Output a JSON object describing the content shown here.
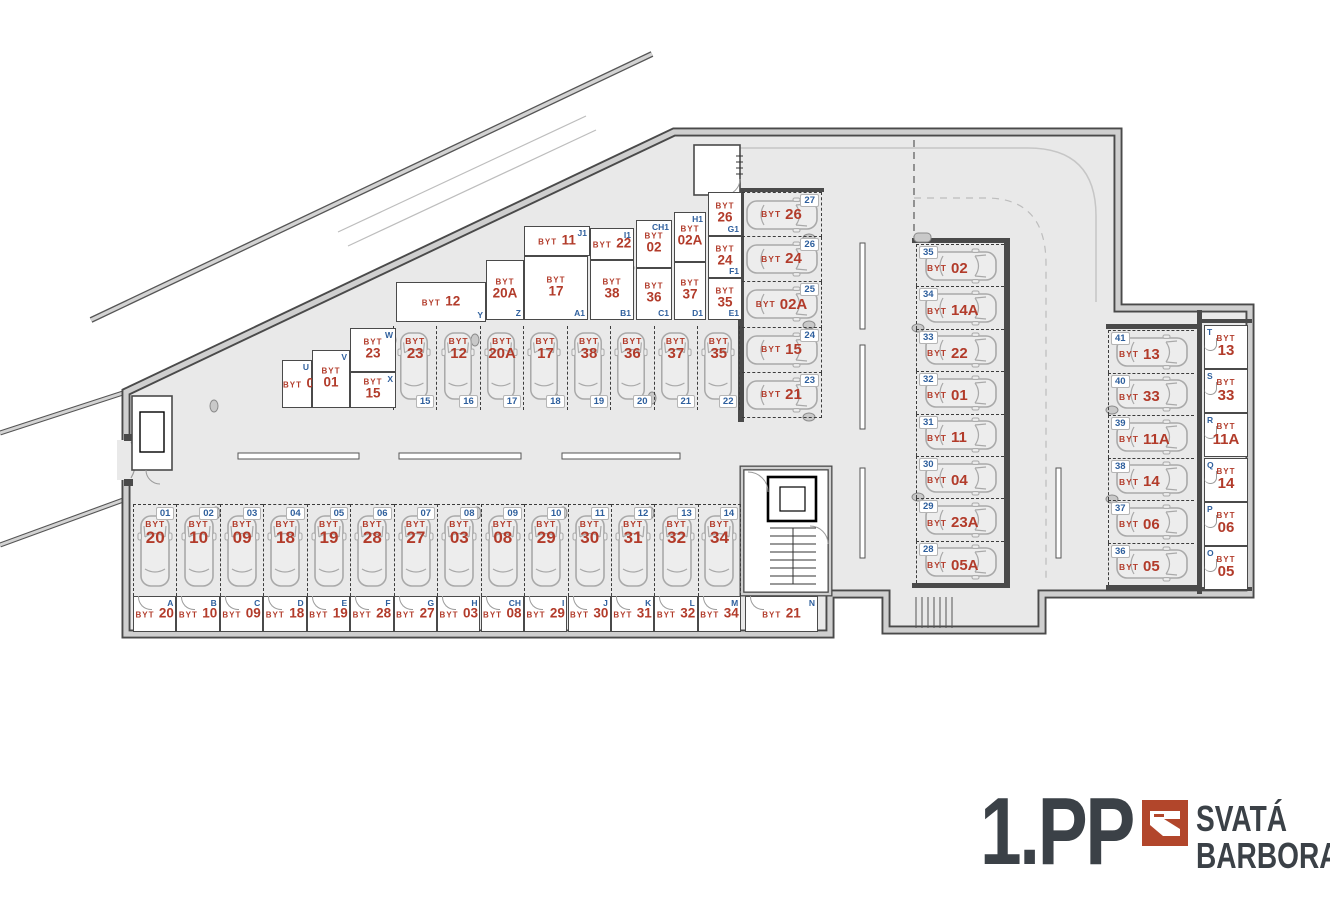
{
  "labels": {
    "unit_prefix": "BYT"
  },
  "title": {
    "floor": "1.PP",
    "brand_line1": "SVATÁ",
    "brand_line2": "BARBORA"
  },
  "colors": {
    "unit_red": "#b23b2a",
    "mark_blue": "#2e5f9d",
    "brand_rust": "#b2462b",
    "wall_dark": "#4a4a4a",
    "floor_gray": "#e9e9e9"
  },
  "parking": {
    "bottom_row": [
      {
        "num": "01",
        "unit": "20",
        "x": 133,
        "y": 504,
        "w": 43.4,
        "h": 92
      },
      {
        "num": "02",
        "unit": "10",
        "x": 176.4,
        "y": 504,
        "w": 43.4,
        "h": 92
      },
      {
        "num": "03",
        "unit": "09",
        "x": 219.9,
        "y": 504,
        "w": 43.4,
        "h": 92
      },
      {
        "num": "04",
        "unit": "18",
        "x": 263.3,
        "y": 504,
        "w": 43.4,
        "h": 92
      },
      {
        "num": "05",
        "unit": "19",
        "x": 306.8,
        "y": 504,
        "w": 43.4,
        "h": 92
      },
      {
        "num": "06",
        "unit": "28",
        "x": 350.2,
        "y": 504,
        "w": 43.4,
        "h": 92
      },
      {
        "num": "07",
        "unit": "27",
        "x": 393.7,
        "y": 504,
        "w": 43.4,
        "h": 92
      },
      {
        "num": "08",
        "unit": "03",
        "x": 437.1,
        "y": 504,
        "w": 43.4,
        "h": 92
      },
      {
        "num": "09",
        "unit": "08",
        "x": 480.6,
        "y": 504,
        "w": 43.4,
        "h": 92
      },
      {
        "num": "10",
        "unit": "29",
        "x": 524,
        "y": 504,
        "w": 43.4,
        "h": 92
      },
      {
        "num": "11",
        "unit": "30",
        "x": 567.5,
        "y": 504,
        "w": 43.4,
        "h": 92
      },
      {
        "num": "12",
        "unit": "31",
        "x": 610.9,
        "y": 504,
        "w": 43.4,
        "h": 92
      },
      {
        "num": "13",
        "unit": "32",
        "x": 654.4,
        "y": 504,
        "w": 43.4,
        "h": 92
      },
      {
        "num": "14",
        "unit": "34",
        "x": 697.8,
        "y": 504,
        "w": 43.4,
        "h": 92,
        "cls": "last"
      }
    ],
    "diagonal_row": [
      {
        "num": "15",
        "unit": "23",
        "x": 393,
        "y": 326,
        "w": 43.4,
        "h": 84
      },
      {
        "num": "16",
        "unit": "12",
        "x": 436.4,
        "y": 326,
        "w": 43.4,
        "h": 84
      },
      {
        "num": "17",
        "unit": "20A",
        "x": 479.9,
        "y": 326,
        "w": 43.4,
        "h": 84
      },
      {
        "num": "18",
        "unit": "17",
        "x": 523.3,
        "y": 326,
        "w": 43.4,
        "h": 84
      },
      {
        "num": "19",
        "unit": "38",
        "x": 566.8,
        "y": 326,
        "w": 43.4,
        "h": 84
      },
      {
        "num": "20",
        "unit": "36",
        "x": 610.2,
        "y": 326,
        "w": 43.4,
        "h": 84
      },
      {
        "num": "21",
        "unit": "37",
        "x": 653.7,
        "y": 326,
        "w": 43.4,
        "h": 84
      },
      {
        "num": "22",
        "unit": "35",
        "x": 697.1,
        "y": 326,
        "w": 43.4,
        "h": 84,
        "cls": "last"
      }
    ],
    "mid_stack": [
      {
        "num": "27",
        "unit": "26",
        "x": 742,
        "y": 192,
        "w": 80,
        "h": 45.2,
        "cls": "first"
      },
      {
        "num": "26",
        "unit": "24",
        "x": 742,
        "y": 237.2,
        "w": 80,
        "h": 45.2
      },
      {
        "num": "25",
        "unit": "02A",
        "x": 742,
        "y": 282.4,
        "w": 80,
        "h": 45.2
      },
      {
        "num": "24",
        "unit": "15",
        "x": 742,
        "y": 327.6,
        "w": 80,
        "h": 45.2
      },
      {
        "num": "23",
        "unit": "21",
        "x": 742,
        "y": 372.8,
        "w": 80,
        "h": 45.2
      }
    ],
    "right_column": [
      {
        "num": "35",
        "unit": "02",
        "x": 916,
        "y": 244,
        "w": 88,
        "h": 42.4
      },
      {
        "num": "34",
        "unit": "14A",
        "x": 916,
        "y": 286.4,
        "w": 88,
        "h": 42.4
      },
      {
        "num": "33",
        "unit": "22",
        "x": 916,
        "y": 328.8,
        "w": 88,
        "h": 42.4
      },
      {
        "num": "32",
        "unit": "01",
        "x": 916,
        "y": 371.2,
        "w": 88,
        "h": 42.4
      },
      {
        "num": "31",
        "unit": "11",
        "x": 916,
        "y": 413.6,
        "w": 88,
        "h": 42.4
      },
      {
        "num": "30",
        "unit": "04",
        "x": 916,
        "y": 456,
        "w": 88,
        "h": 42.4
      },
      {
        "num": "29",
        "unit": "23A",
        "x": 916,
        "y": 498.4,
        "w": 88,
        "h": 42.4
      },
      {
        "num": "28",
        "unit": "05A",
        "x": 916,
        "y": 540.8,
        "w": 88,
        "h": 42.4
      }
    ],
    "far_right_column": [
      {
        "num": "41",
        "unit": "13",
        "x": 1108,
        "y": 330,
        "w": 86,
        "h": 42.5
      },
      {
        "num": "40",
        "unit": "33",
        "x": 1108,
        "y": 372.5,
        "w": 86,
        "h": 42.5
      },
      {
        "num": "39",
        "unit": "11A",
        "x": 1108,
        "y": 415,
        "w": 86,
        "h": 42.5
      },
      {
        "num": "38",
        "unit": "14",
        "x": 1108,
        "y": 457.5,
        "w": 86,
        "h": 42.5
      },
      {
        "num": "37",
        "unit": "06",
        "x": 1108,
        "y": 500,
        "w": 86,
        "h": 42.5
      },
      {
        "num": "36",
        "unit": "05",
        "x": 1108,
        "y": 542.5,
        "w": 86,
        "h": 42.5
      }
    ]
  },
  "cellars": {
    "bottom_row": [
      {
        "letter": "A",
        "unit": "20",
        "x": 133,
        "y": 596,
        "w": 43.4,
        "h": 36
      },
      {
        "letter": "B",
        "unit": "10",
        "x": 176.4,
        "y": 596,
        "w": 43.4,
        "h": 36
      },
      {
        "letter": "C",
        "unit": "09",
        "x": 219.9,
        "y": 596,
        "w": 43.4,
        "h": 36
      },
      {
        "letter": "D",
        "unit": "18",
        "x": 263.3,
        "y": 596,
        "w": 43.4,
        "h": 36
      },
      {
        "letter": "E",
        "unit": "19",
        "x": 306.8,
        "y": 596,
        "w": 43.4,
        "h": 36
      },
      {
        "letter": "F",
        "unit": "28",
        "x": 350.2,
        "y": 596,
        "w": 43.4,
        "h": 36
      },
      {
        "letter": "G",
        "unit": "27",
        "x": 393.7,
        "y": 596,
        "w": 43.4,
        "h": 36
      },
      {
        "letter": "H",
        "unit": "03",
        "x": 437.1,
        "y": 596,
        "w": 43.4,
        "h": 36
      },
      {
        "letter": "CH",
        "unit": "08",
        "x": 480.6,
        "y": 596,
        "w": 43.4,
        "h": 36
      },
      {
        "letter": "I",
        "unit": "29",
        "x": 524,
        "y": 596,
        "w": 43.4,
        "h": 36
      },
      {
        "letter": "J",
        "unit": "30",
        "x": 567.5,
        "y": 596,
        "w": 43.4,
        "h": 36
      },
      {
        "letter": "K",
        "unit": "31",
        "x": 610.9,
        "y": 596,
        "w": 43.4,
        "h": 36
      },
      {
        "letter": "L",
        "unit": "32",
        "x": 654.4,
        "y": 596,
        "w": 43.4,
        "h": 36
      },
      {
        "letter": "M",
        "unit": "34",
        "x": 697.8,
        "y": 596,
        "w": 43.4,
        "h": 36
      },
      {
        "letter": "N",
        "unit": "21",
        "x": 745,
        "y": 596,
        "w": 73,
        "h": 36
      }
    ],
    "right_column": [
      {
        "letter": "T",
        "unit": "13",
        "x": 1204,
        "y": 325,
        "w": 44,
        "h": 44.2
      },
      {
        "letter": "S",
        "unit": "33",
        "x": 1204,
        "y": 369.2,
        "w": 44,
        "h": 44.2
      },
      {
        "letter": "R",
        "unit": "11A",
        "x": 1204,
        "y": 413.3,
        "w": 44,
        "h": 44.2
      },
      {
        "letter": "Q",
        "unit": "14",
        "x": 1204,
        "y": 457.5,
        "w": 44,
        "h": 44.2
      },
      {
        "letter": "P",
        "unit": "06",
        "x": 1204,
        "y": 501.7,
        "w": 44,
        "h": 44.2
      },
      {
        "letter": "O",
        "unit": "05",
        "x": 1204,
        "y": 545.8,
        "w": 44,
        "h": 44.2
      }
    ],
    "diagonal_band": [
      {
        "letter": "U",
        "unit": "04",
        "x": 282,
        "y": 360,
        "w": 30,
        "h": 48,
        "cls": "inline"
      },
      {
        "letter": "V",
        "unit": "01",
        "x": 312,
        "y": 350,
        "w": 38,
        "h": 58,
        "cls": "stacked"
      },
      {
        "letter": "W",
        "unit": "23",
        "x": 350,
        "y": 328,
        "w": 46,
        "h": 44,
        "cls": "stacked"
      },
      {
        "letter": "X",
        "unit": "15",
        "x": 350,
        "y": 372,
        "w": 46,
        "h": 36,
        "cls": "stacked"
      },
      {
        "letter": "Y",
        "unit": "12",
        "x": 396,
        "y": 282,
        "w": 90,
        "h": 40,
        "cls": "inline letter-br"
      },
      {
        "letter": "Z",
        "unit": "20A",
        "x": 486,
        "y": 260,
        "w": 38,
        "h": 60,
        "cls": "stacked letter-br"
      },
      {
        "letter": "J1",
        "unit": "11",
        "x": 524,
        "y": 226,
        "w": 66,
        "h": 30,
        "cls": "inline"
      },
      {
        "letter": "A1",
        "unit": "17",
        "x": 524,
        "y": 256,
        "w": 64,
        "h": 64,
        "cls": "stacked letter-br"
      },
      {
        "letter": "I1",
        "unit": "22",
        "x": 590,
        "y": 228,
        "w": 44,
        "h": 32,
        "cls": "inline"
      },
      {
        "letter": "B1",
        "unit": "38",
        "x": 590,
        "y": 260,
        "w": 44,
        "h": 60,
        "cls": "stacked letter-br"
      },
      {
        "letter": "CH1",
        "unit": "02",
        "x": 636,
        "y": 220,
        "w": 36,
        "h": 48,
        "cls": "stacked"
      },
      {
        "letter": "C1",
        "unit": "36",
        "x": 636,
        "y": 268,
        "w": 36,
        "h": 52,
        "cls": "stacked letter-br"
      },
      {
        "letter": "H1",
        "unit": "02A",
        "x": 674,
        "y": 212,
        "w": 32,
        "h": 50,
        "cls": "stacked"
      },
      {
        "letter": "D1",
        "unit": "37",
        "x": 674,
        "y": 262,
        "w": 32,
        "h": 58,
        "cls": "stacked letter-br"
      },
      {
        "letter": "G1",
        "unit": "26",
        "x": 708,
        "y": 192,
        "w": 34,
        "h": 44,
        "cls": "stacked letter-br"
      },
      {
        "letter": "F1",
        "unit": "24",
        "x": 708,
        "y": 236,
        "w": 34,
        "h": 42,
        "cls": "stacked letter-br"
      },
      {
        "letter": "E1",
        "unit": "35",
        "x": 708,
        "y": 278,
        "w": 34,
        "h": 42,
        "cls": "stacked letter-br"
      }
    ]
  }
}
